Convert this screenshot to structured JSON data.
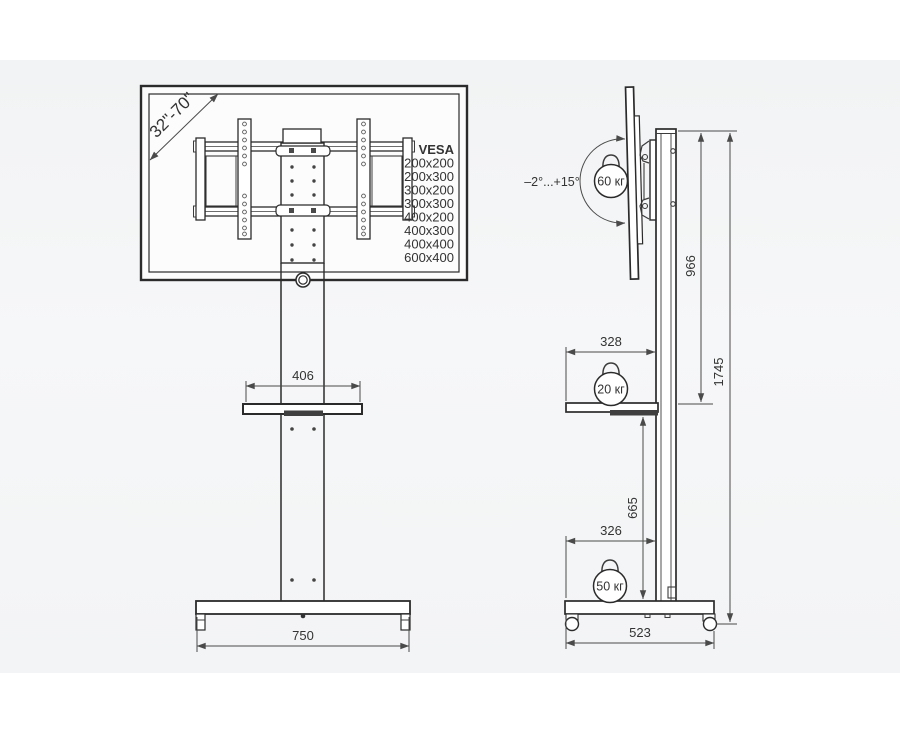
{
  "diagram": {
    "front_view": {
      "screen_range": "32\"-70\"",
      "vesa_title": "VESA",
      "vesa_sizes": [
        "200x200",
        "200x300",
        "300x200",
        "300x300",
        "400x200",
        "400x300",
        "400x400",
        "600x400"
      ],
      "shelf_width": "406",
      "base_width": "750"
    },
    "side_view": {
      "tilt_range": "–2°...+15°",
      "max_tv_weight": "60 кг",
      "max_shelf_weight": "20 кг",
      "max_base_weight": "50 кг",
      "bracket_height": "966",
      "total_height": "1745",
      "shelf_depth": "328",
      "shelf_to_base": "665",
      "base_inner_depth": "326",
      "base_depth": "523"
    }
  },
  "colors": {
    "outline": "#2b2b2b",
    "dimension": "#4a4a4a",
    "text": "#333333",
    "panel_top": "#f2f3f4",
    "panel_bottom": "#f3f4f5"
  }
}
